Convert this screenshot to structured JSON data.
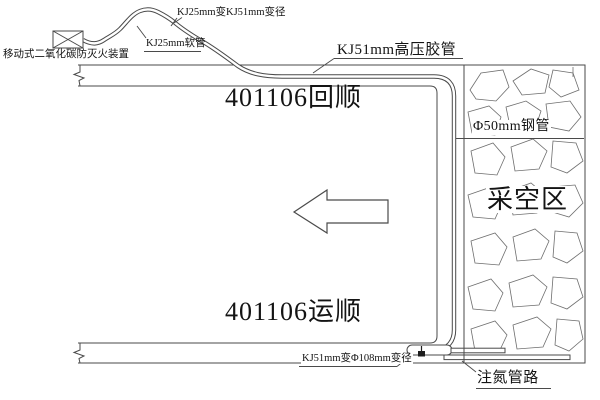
{
  "diagram": {
    "title_context": "mine working face nitrogen-injection / CO2 fire prevention schematic",
    "labels": {
      "co2_device": "移动式二氧化碳防灭火装置",
      "kj25_reducer": "KJ25mm变KJ51mm变径",
      "kj25_hose": "KJ25mm软管",
      "kj51_hose": "KJ51mm高压胶管",
      "return_airway": "401106回顺",
      "transport_airway": "401106运顺",
      "steel_pipe": "Φ50mm钢管",
      "goaf": "采空区",
      "kj51_phi108_reducer": "KJ51mm变Φ108mm变径",
      "nitrogen_pipeline": "注氮管路"
    },
    "colors": {
      "line": "#4a4a4a",
      "rock_pattern": "#6e6e6e",
      "text": "#141414",
      "background": "#ffffff",
      "valve": "#1d1d1d"
    }
  }
}
